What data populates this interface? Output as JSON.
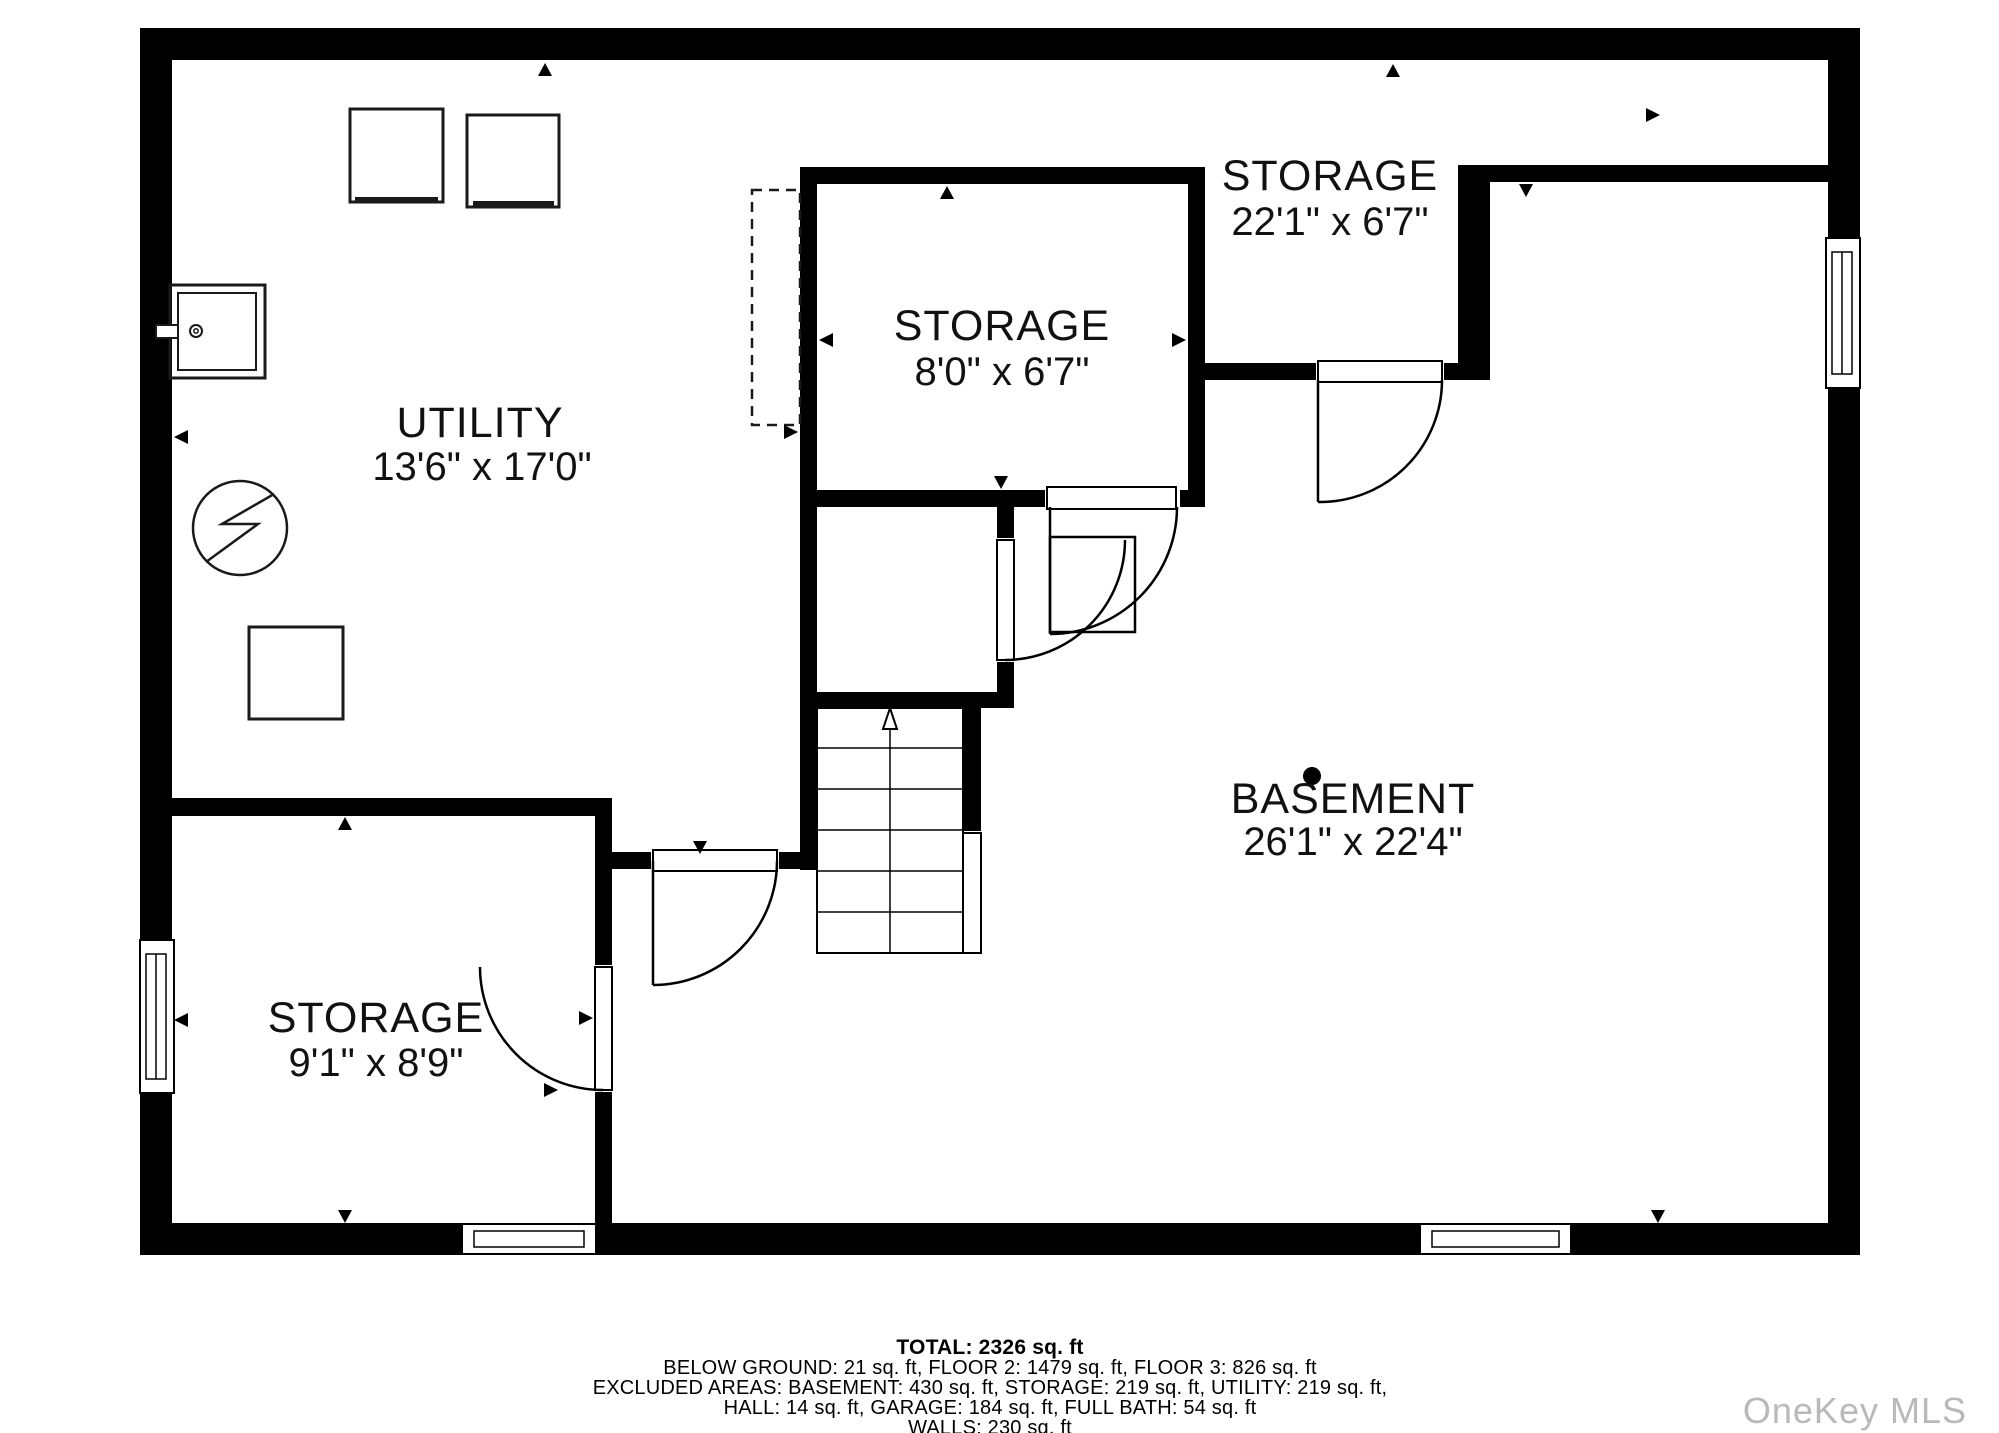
{
  "floorplan": {
    "rooms": {
      "utility": {
        "name": "UTILITY",
        "dims": "13'6\" x 17'0\""
      },
      "storage_mid": {
        "name": "STORAGE",
        "dims": "8'0\" x 6'7\""
      },
      "storage_top": {
        "name": "STORAGE",
        "dims": "22'1\" x 6'7\""
      },
      "storage_bl": {
        "name": "STORAGE",
        "dims": "9'1\" x 8'9\""
      },
      "basement": {
        "name": "BASEMENT",
        "dims": "26'1\" x 22'4\""
      }
    }
  },
  "footer": {
    "total": "TOTAL: 2326 sq. ft",
    "line2": "BELOW GROUND: 21 sq. ft, FLOOR 2: 1479 sq. ft, FLOOR 3: 826 sq. ft",
    "line3": "EXCLUDED AREAS: BASEMENT: 430 sq. ft, STORAGE: 219 sq. ft, UTILITY: 219 sq. ft,",
    "line4": "HALL: 14 sq. ft, GARAGE: 184 sq. ft, FULL BATH: 54 sq. ft",
    "line5": "WALLS: 230 sq. ft"
  },
  "watermark": "OneKey MLS",
  "colors": {
    "wall": "#000000",
    "background": "#ffffff",
    "watermark": "#b9b9b9"
  }
}
